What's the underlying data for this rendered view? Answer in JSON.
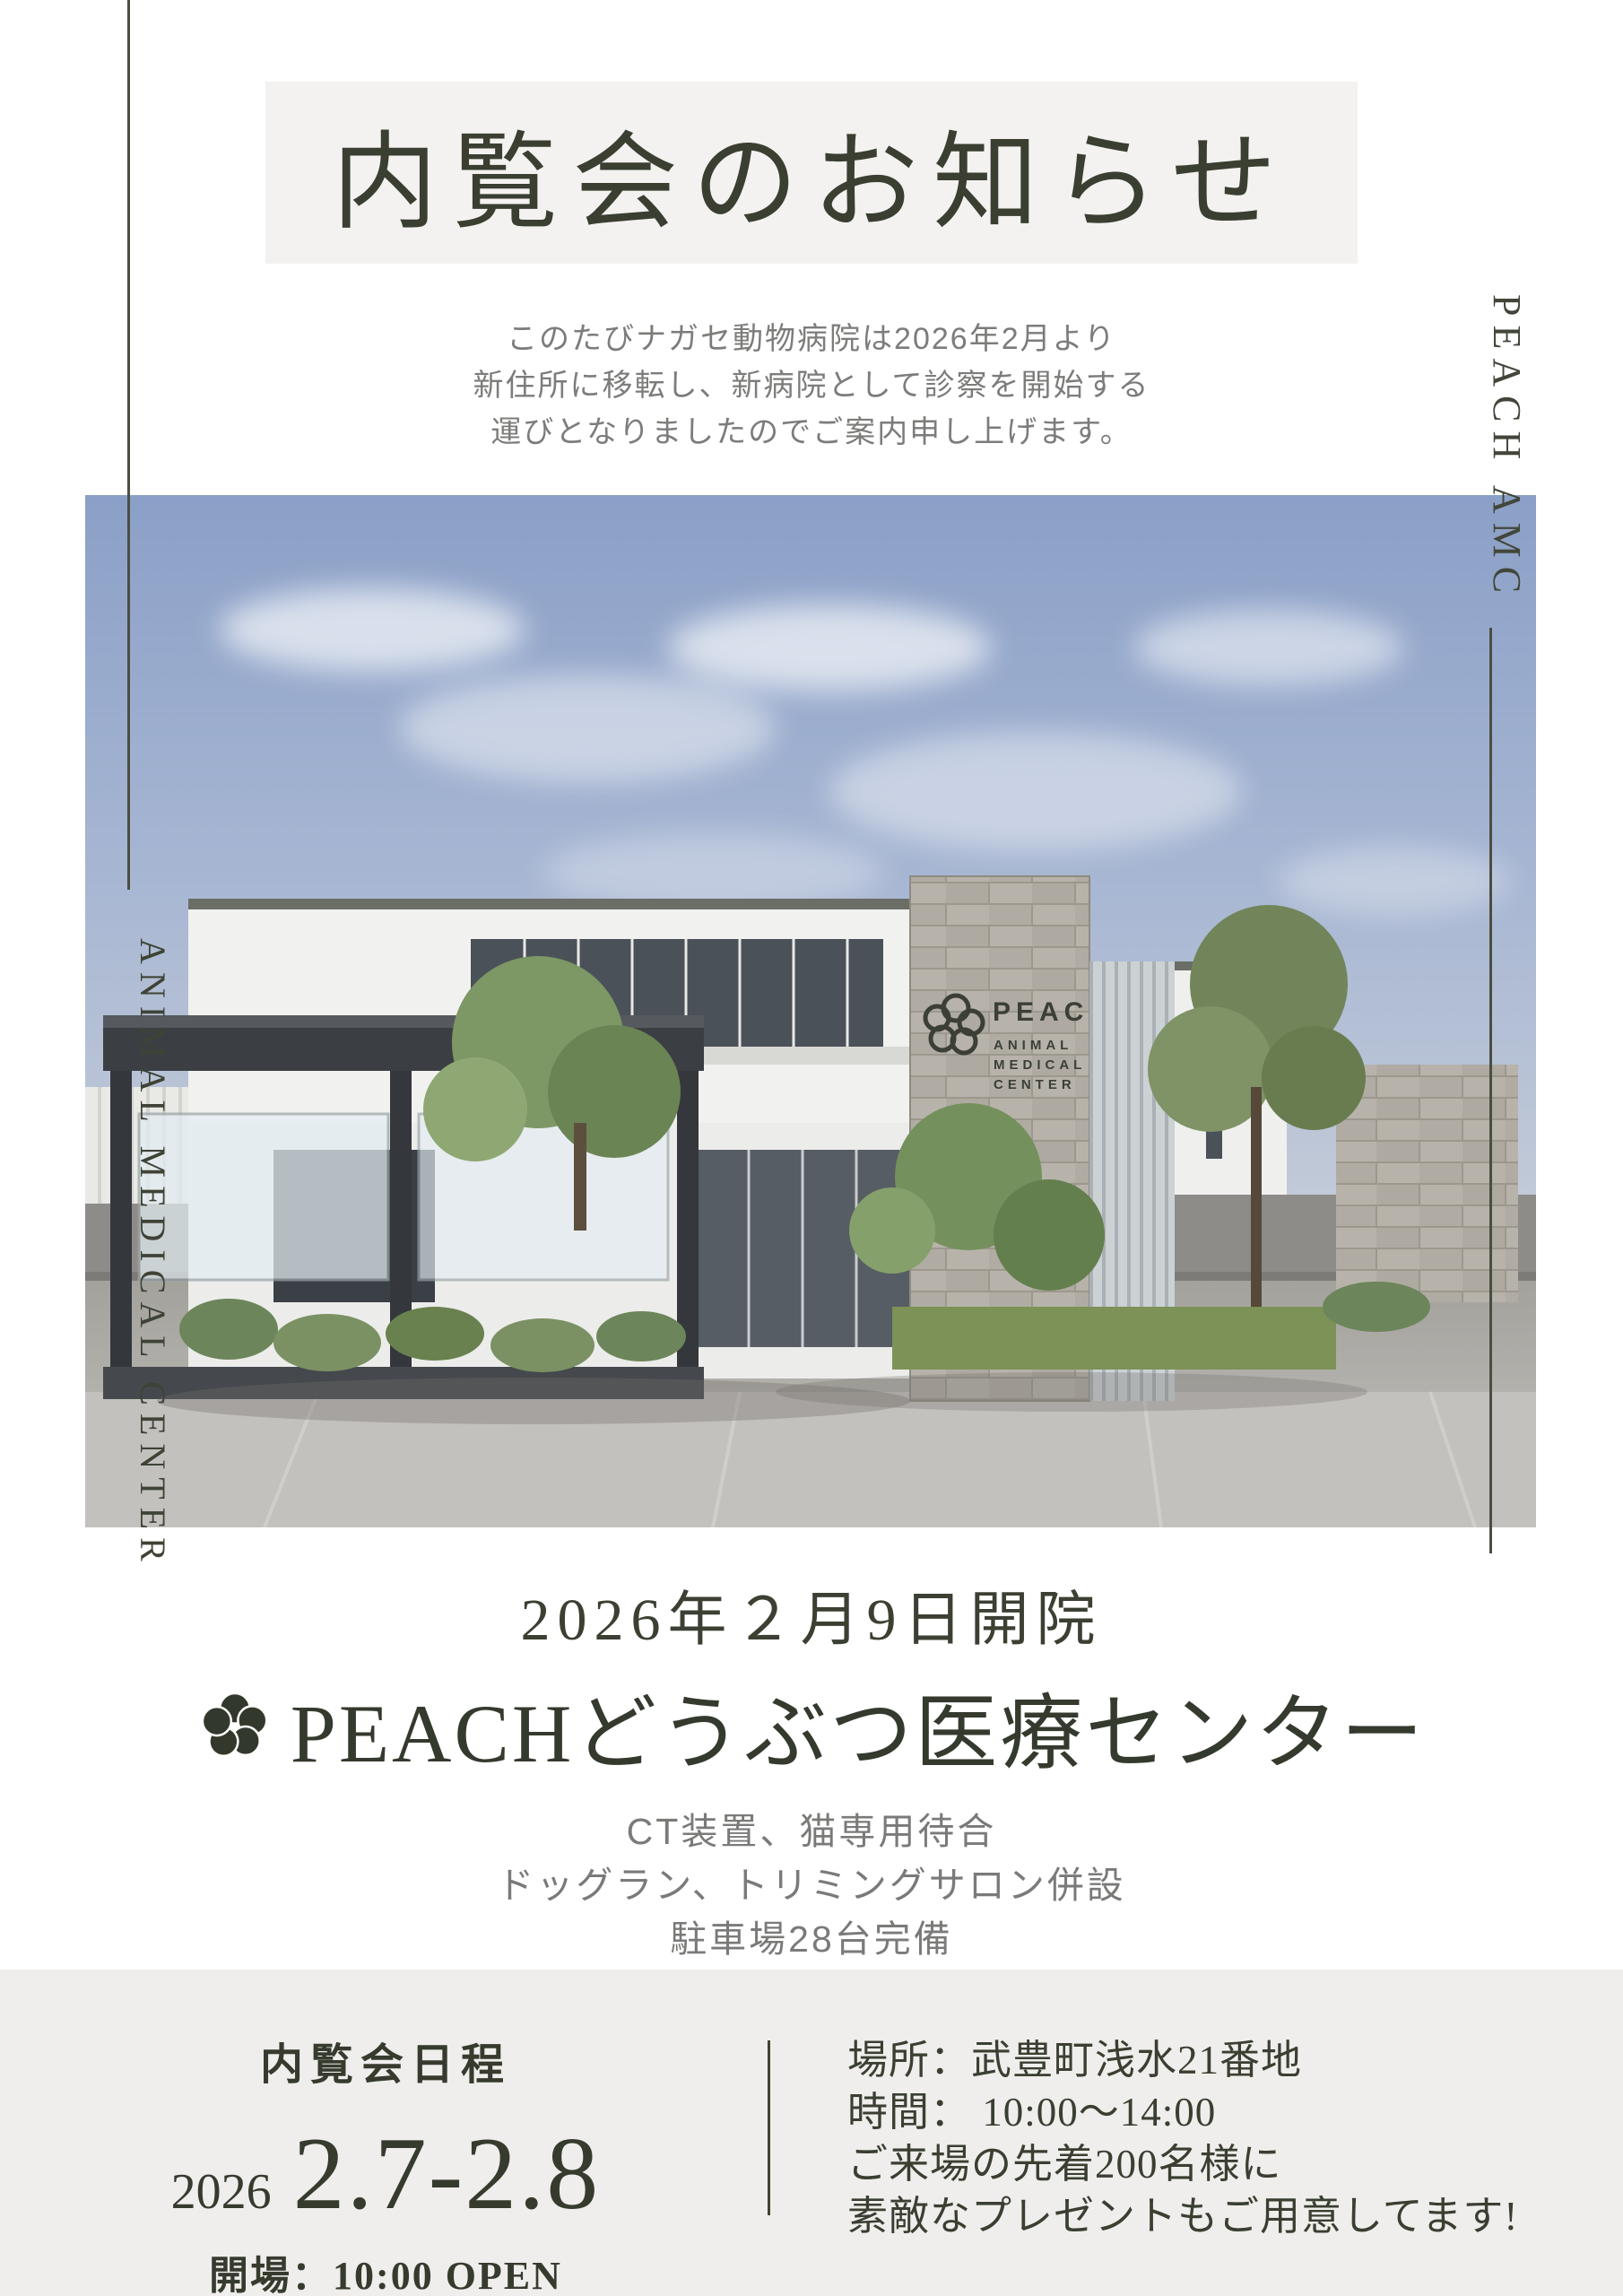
{
  "title_box": {
    "text": "内覧会のお知らせ",
    "bg": "#f3f2f0",
    "color": "#3a3f31"
  },
  "announcement": {
    "lines": [
      "このたびナガセ動物病院は2026年2月より",
      "新住所に移転し、新病院として診察を開始する",
      "運びとなりましたのでご案内申し上げます。"
    ]
  },
  "vertical_text": {
    "right": "PEACH AMC",
    "left": "ANIMAL MEDICAL CENTER"
  },
  "photo_sign": {
    "brand": "PEACH",
    "line1": "ANIMAL",
    "line2": "MEDICAL",
    "line3": "CENTER"
  },
  "opening": {
    "date_line": "2026年２月9日開院"
  },
  "main_title": {
    "name": "PEACHどうぶつ医療センター"
  },
  "features": {
    "lines": [
      "CT装置、猫専用待合",
      "ドッグラン、トリミングサロン併設",
      "駐車場28台完備"
    ]
  },
  "footer": {
    "schedule_heading": "内覧会日程",
    "year": "2026",
    "dates": "2.7-2.8",
    "open_line": "開場：10:00 OPEN",
    "details": [
      "場所：武豊町浅水21番地",
      "時間： 10:00〜14:00",
      "ご来場の先着200名様に",
      "素敵なプレゼントもご用意してます!"
    ]
  },
  "colors": {
    "accent_dark_olive": "#3a3f31",
    "paragraph_gray": "#7c7c7a",
    "footer_bg": "#efeeec",
    "title_box_bg": "#f3f2f0"
  }
}
